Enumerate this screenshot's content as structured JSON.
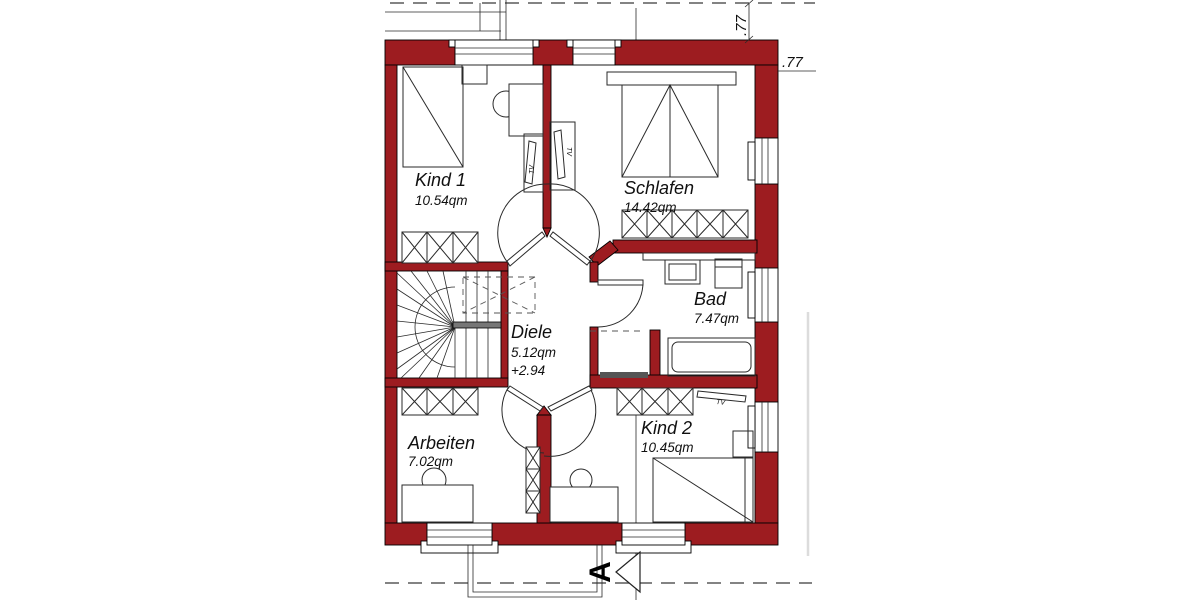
{
  "plan": {
    "type": "floor-plan-upper-storey",
    "rooms": [
      {
        "name": "Kind 1",
        "area": "10.54qm"
      },
      {
        "name": "Schlafen",
        "area": "14.42qm"
      },
      {
        "name": "Bad",
        "area": "7.47qm"
      },
      {
        "name": "Diele",
        "area": "5.12qm",
        "level": "+2.94"
      },
      {
        "name": "Arbeiten",
        "area": "7.02qm"
      },
      {
        "name": "Kind 2",
        "area": "10.45qm"
      }
    ],
    "dimensions": {
      "roof_overhang_vertical": ".77",
      "roof_overhang_horizontal": ".77"
    },
    "section_marker": "A",
    "furniture_labels": {
      "tv_kind1": "TV",
      "tv_schlafen": "TV",
      "tv_kind2": "TV"
    },
    "colors": {
      "wall": "#9d1c20",
      "line": "#2a2a2a",
      "dashed": "#5a5a5a",
      "light_guide": "#dcdcdc"
    }
  }
}
